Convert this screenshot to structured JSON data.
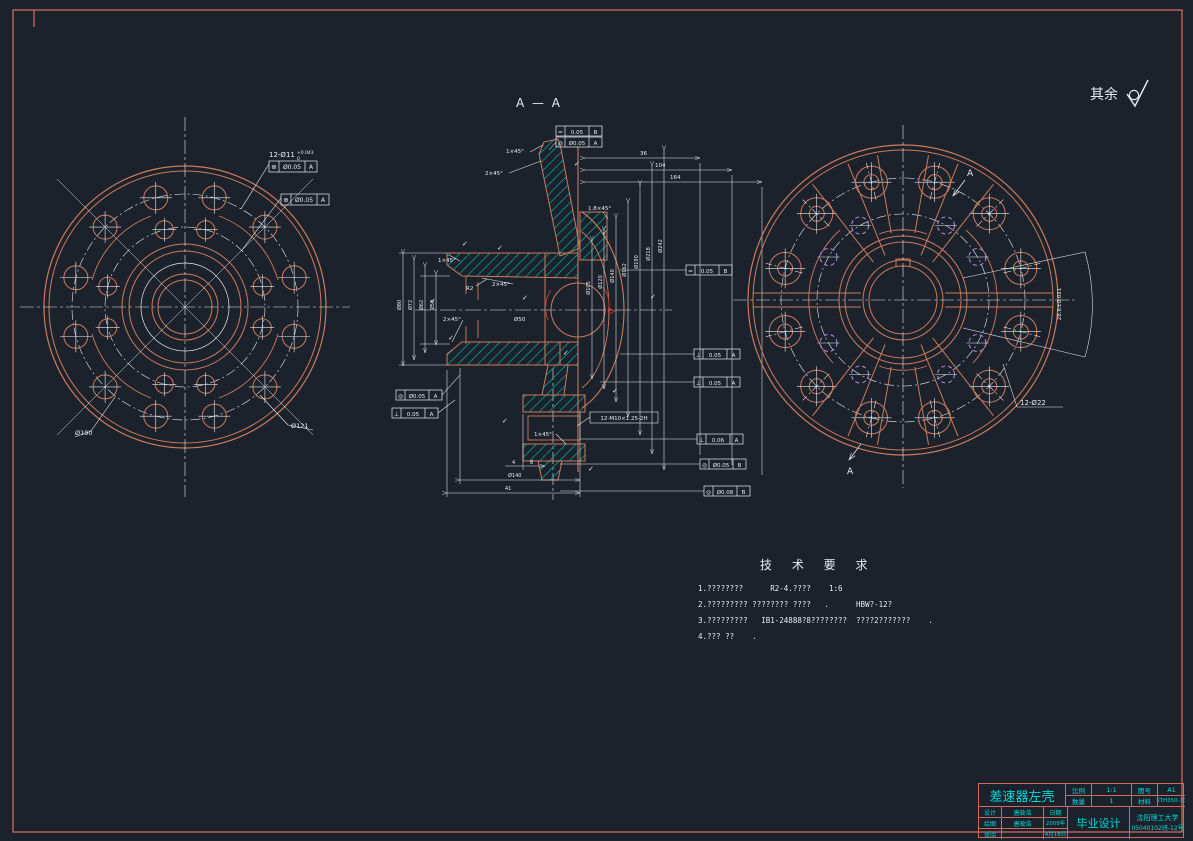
{
  "colors": {
    "background": "#1c222b",
    "line_orange": "#cc7a5c",
    "line_white": "#e8ecf0",
    "hatch_teal": "#00a79b",
    "accent_cyan": "#00dada",
    "frame_red": "#d0685c",
    "violet": "#b48ce0",
    "highlight_red": "#c03631"
  },
  "glyphs": {
    "check": "✓",
    "roughness": "check-with-circle"
  },
  "header": {
    "section_label": "A — A",
    "surface_note": "其余"
  },
  "left_view": {
    "hole_note": "12-Ø11",
    "hole_note_tol_up": "+0.043",
    "hole_note_tol_dn": "0",
    "gdt_frames": [
      {
        "sym": "⊕",
        "val": "Ø0.05",
        "datum": "A"
      },
      {
        "sym": "⊕",
        "val": "Ø0.05",
        "datum": "A"
      }
    ],
    "dim_bottom_left": "Ø190",
    "dim_bottom_right": "Ø121"
  },
  "section_view": {
    "chamfer_labels": [
      "1×45°",
      "2×45°",
      "1.8×45°",
      "1×45°",
      "2×45°",
      "2×45°",
      "1×45°"
    ],
    "radius_label": "R2",
    "bore_dim": "Ø50",
    "thread_note": "12-M10×1.25-2H",
    "gdt_top": [
      {
        "sym": "=",
        "val": "0.05",
        "datum": "B"
      },
      {
        "sym": "◎",
        "val": "Ø0.05",
        "datum": "A"
      }
    ],
    "gdt_right": [
      {
        "sym": "=",
        "val": "0.05",
        "datum": "B"
      },
      {
        "sym": "⊥",
        "val": "0.05",
        "datum": "A"
      },
      {
        "sym": "⊥",
        "val": "0.05",
        "datum": "A"
      },
      {
        "sym": "⊥",
        "val": "0.06",
        "datum": "A"
      },
      {
        "sym": "◎",
        "val": "Ø0.05",
        "datum": "B"
      },
      {
        "sym": "◎",
        "val": "Ø0.08",
        "datum": "B"
      }
    ],
    "gdt_left": [
      {
        "sym": "◎",
        "val": "Ø0.05",
        "datum": "A"
      },
      {
        "sym": "⊥",
        "val": "0.05",
        "datum": "A"
      }
    ],
    "dims": {
      "left_stack": [
        "Ø50",
        "Ø62",
        "Ø72",
        "Ø80"
      ],
      "right_stack": [
        "Ø105",
        "Ø120",
        "Ø140",
        "Ø162",
        "Ø190",
        "Ø218",
        "Ø242"
      ],
      "top": [
        "36",
        "104",
        "164"
      ],
      "bottom": [
        "4",
        "8",
        "Ø140",
        "41"
      ]
    }
  },
  "right_view": {
    "hole_note": "12-Ø22",
    "arc_dim": "28.6±0.021",
    "section_arrow": "A"
  },
  "tech_req": {
    "title": "技 术 要 求",
    "lines": [
      "1.????????      R2-4.????    1:6",
      "2.????????? ???????? ????   .      HBW?-12?",
      "3.?????????   IB1-24888?8????????  ????2???????    .",
      "4.??? ??    ."
    ]
  },
  "title_block": {
    "part_name": "差速器左壳",
    "scale_label": "比例",
    "scale_value": "1:1",
    "qty_label": "数量",
    "qty_value": "1",
    "drawing_no_label": "图号",
    "drawing_no_value": "A1",
    "material_label": "材料",
    "material_value": "KTH350-10",
    "design_label": "设计",
    "design_name": "唐政浩",
    "draw_label": "绘图",
    "draw_name": "唐政浩",
    "review_label": "审阅",
    "date_label": "日期",
    "date_year": "2009年",
    "date_day": "4月18日",
    "project": "毕业设计",
    "school": "沈阳理工大学",
    "class_no": "05040102班-12号"
  }
}
